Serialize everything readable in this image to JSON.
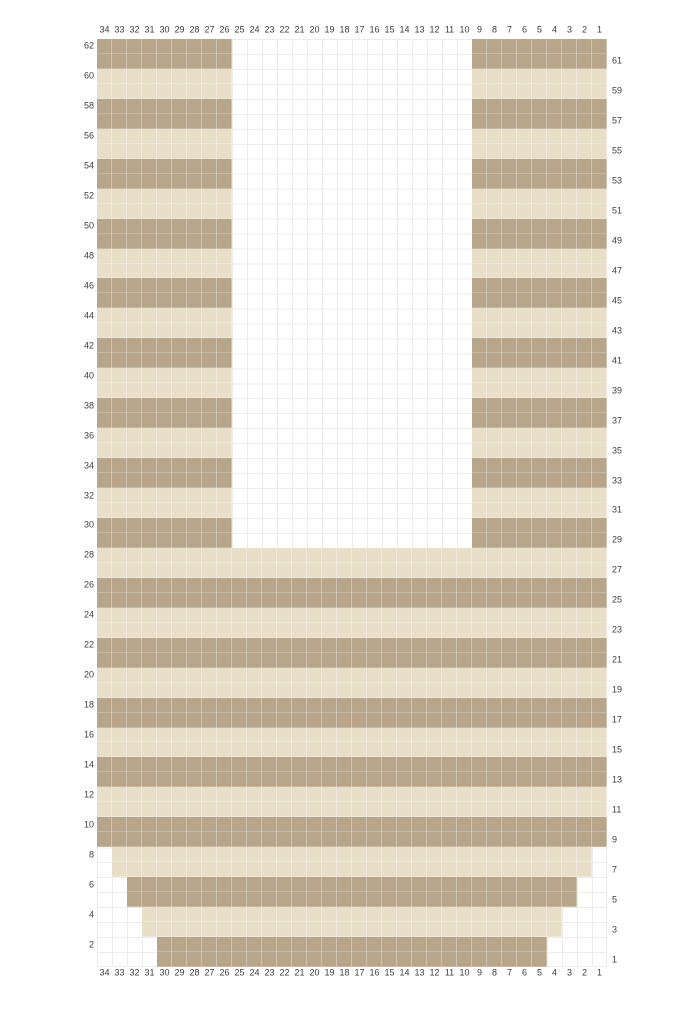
{
  "chart_data": {
    "type": "heatmap",
    "title": "",
    "description": "Two-color knitting/colorwork grid chart, 34 stitches wide by 62 rows tall, striped in two-row bands, with a center neck opening (columns 25-10 empty from row 29 upward) and stepped decrease shaping at the bottom corners (rows 1-8).",
    "columns_left_to_right": [
      34,
      33,
      32,
      31,
      30,
      29,
      28,
      27,
      26,
      25,
      24,
      23,
      22,
      21,
      20,
      19,
      18,
      17,
      16,
      15,
      14,
      13,
      12,
      11,
      10,
      9,
      8,
      7,
      6,
      5,
      4,
      3,
      2,
      1
    ],
    "rows_top_to_bottom": [
      62,
      61,
      60,
      59,
      58,
      57,
      56,
      55,
      54,
      53,
      52,
      51,
      50,
      49,
      48,
      47,
      46,
      45,
      44,
      43,
      42,
      41,
      40,
      39,
      38,
      37,
      36,
      35,
      34,
      33,
      32,
      31,
      30,
      29,
      28,
      27,
      26,
      25,
      24,
      23,
      22,
      21,
      20,
      19,
      18,
      17,
      16,
      15,
      14,
      13,
      12,
      11,
      10,
      9,
      8,
      7,
      6,
      5,
      4,
      3,
      2,
      1
    ],
    "colors": {
      "dark": "#b7a68b",
      "light": "#e9dfc9",
      "empty": "#ffffff",
      "gridline": "#ececec",
      "label": "#3d3d3d"
    },
    "stripe_rule": "two-row horizontal stripes; rows 1-2 dark, 3-4 light, alternating upward",
    "rows": [
      {
        "row": 62,
        "color": "dark",
        "spans": [
          [
            34,
            26
          ],
          [
            9,
            1
          ]
        ]
      },
      {
        "row": 61,
        "color": "dark",
        "spans": [
          [
            34,
            26
          ],
          [
            9,
            1
          ]
        ]
      },
      {
        "row": 60,
        "color": "light",
        "spans": [
          [
            34,
            26
          ],
          [
            9,
            1
          ]
        ]
      },
      {
        "row": 59,
        "color": "light",
        "spans": [
          [
            34,
            26
          ],
          [
            9,
            1
          ]
        ]
      },
      {
        "row": 58,
        "color": "dark",
        "spans": [
          [
            34,
            26
          ],
          [
            9,
            1
          ]
        ]
      },
      {
        "row": 57,
        "color": "dark",
        "spans": [
          [
            34,
            26
          ],
          [
            9,
            1
          ]
        ]
      },
      {
        "row": 56,
        "color": "light",
        "spans": [
          [
            34,
            26
          ],
          [
            9,
            1
          ]
        ]
      },
      {
        "row": 55,
        "color": "light",
        "spans": [
          [
            34,
            26
          ],
          [
            9,
            1
          ]
        ]
      },
      {
        "row": 54,
        "color": "dark",
        "spans": [
          [
            34,
            26
          ],
          [
            9,
            1
          ]
        ]
      },
      {
        "row": 53,
        "color": "dark",
        "spans": [
          [
            34,
            26
          ],
          [
            9,
            1
          ]
        ]
      },
      {
        "row": 52,
        "color": "light",
        "spans": [
          [
            34,
            26
          ],
          [
            9,
            1
          ]
        ]
      },
      {
        "row": 51,
        "color": "light",
        "spans": [
          [
            34,
            26
          ],
          [
            9,
            1
          ]
        ]
      },
      {
        "row": 50,
        "color": "dark",
        "spans": [
          [
            34,
            26
          ],
          [
            9,
            1
          ]
        ]
      },
      {
        "row": 49,
        "color": "dark",
        "spans": [
          [
            34,
            26
          ],
          [
            9,
            1
          ]
        ]
      },
      {
        "row": 48,
        "color": "light",
        "spans": [
          [
            34,
            26
          ],
          [
            9,
            1
          ]
        ]
      },
      {
        "row": 47,
        "color": "light",
        "spans": [
          [
            34,
            26
          ],
          [
            9,
            1
          ]
        ]
      },
      {
        "row": 46,
        "color": "dark",
        "spans": [
          [
            34,
            26
          ],
          [
            9,
            1
          ]
        ]
      },
      {
        "row": 45,
        "color": "dark",
        "spans": [
          [
            34,
            26
          ],
          [
            9,
            1
          ]
        ]
      },
      {
        "row": 44,
        "color": "light",
        "spans": [
          [
            34,
            26
          ],
          [
            9,
            1
          ]
        ]
      },
      {
        "row": 43,
        "color": "light",
        "spans": [
          [
            34,
            26
          ],
          [
            9,
            1
          ]
        ]
      },
      {
        "row": 42,
        "color": "dark",
        "spans": [
          [
            34,
            26
          ],
          [
            9,
            1
          ]
        ]
      },
      {
        "row": 41,
        "color": "dark",
        "spans": [
          [
            34,
            26
          ],
          [
            9,
            1
          ]
        ]
      },
      {
        "row": 40,
        "color": "light",
        "spans": [
          [
            34,
            26
          ],
          [
            9,
            1
          ]
        ]
      },
      {
        "row": 39,
        "color": "light",
        "spans": [
          [
            34,
            26
          ],
          [
            9,
            1
          ]
        ]
      },
      {
        "row": 38,
        "color": "dark",
        "spans": [
          [
            34,
            26
          ],
          [
            9,
            1
          ]
        ]
      },
      {
        "row": 37,
        "color": "dark",
        "spans": [
          [
            34,
            26
          ],
          [
            9,
            1
          ]
        ]
      },
      {
        "row": 36,
        "color": "light",
        "spans": [
          [
            34,
            26
          ],
          [
            9,
            1
          ]
        ]
      },
      {
        "row": 35,
        "color": "light",
        "spans": [
          [
            34,
            26
          ],
          [
            9,
            1
          ]
        ]
      },
      {
        "row": 34,
        "color": "dark",
        "spans": [
          [
            34,
            26
          ],
          [
            9,
            1
          ]
        ]
      },
      {
        "row": 33,
        "color": "dark",
        "spans": [
          [
            34,
            26
          ],
          [
            9,
            1
          ]
        ]
      },
      {
        "row": 32,
        "color": "light",
        "spans": [
          [
            34,
            26
          ],
          [
            9,
            1
          ]
        ]
      },
      {
        "row": 31,
        "color": "light",
        "spans": [
          [
            34,
            26
          ],
          [
            9,
            1
          ]
        ]
      },
      {
        "row": 30,
        "color": "dark",
        "spans": [
          [
            34,
            26
          ],
          [
            9,
            1
          ]
        ]
      },
      {
        "row": 29,
        "color": "dark",
        "spans": [
          [
            34,
            26
          ],
          [
            9,
            1
          ]
        ]
      },
      {
        "row": 28,
        "color": "light",
        "spans": [
          [
            34,
            1
          ]
        ]
      },
      {
        "row": 27,
        "color": "light",
        "spans": [
          [
            34,
            1
          ]
        ]
      },
      {
        "row": 26,
        "color": "dark",
        "spans": [
          [
            34,
            1
          ]
        ]
      },
      {
        "row": 25,
        "color": "dark",
        "spans": [
          [
            34,
            1
          ]
        ]
      },
      {
        "row": 24,
        "color": "light",
        "spans": [
          [
            34,
            1
          ]
        ]
      },
      {
        "row": 23,
        "color": "light",
        "spans": [
          [
            34,
            1
          ]
        ]
      },
      {
        "row": 22,
        "color": "dark",
        "spans": [
          [
            34,
            1
          ]
        ]
      },
      {
        "row": 21,
        "color": "dark",
        "spans": [
          [
            34,
            1
          ]
        ]
      },
      {
        "row": 20,
        "color": "light",
        "spans": [
          [
            34,
            1
          ]
        ]
      },
      {
        "row": 19,
        "color": "light",
        "spans": [
          [
            34,
            1
          ]
        ]
      },
      {
        "row": 18,
        "color": "dark",
        "spans": [
          [
            34,
            1
          ]
        ]
      },
      {
        "row": 17,
        "color": "dark",
        "spans": [
          [
            34,
            1
          ]
        ]
      },
      {
        "row": 16,
        "color": "light",
        "spans": [
          [
            34,
            1
          ]
        ]
      },
      {
        "row": 15,
        "color": "light",
        "spans": [
          [
            34,
            1
          ]
        ]
      },
      {
        "row": 14,
        "color": "dark",
        "spans": [
          [
            34,
            1
          ]
        ]
      },
      {
        "row": 13,
        "color": "dark",
        "spans": [
          [
            34,
            1
          ]
        ]
      },
      {
        "row": 12,
        "color": "light",
        "spans": [
          [
            34,
            1
          ]
        ]
      },
      {
        "row": 11,
        "color": "light",
        "spans": [
          [
            34,
            1
          ]
        ]
      },
      {
        "row": 10,
        "color": "dark",
        "spans": [
          [
            34,
            1
          ]
        ]
      },
      {
        "row": 9,
        "color": "dark",
        "spans": [
          [
            34,
            1
          ]
        ]
      },
      {
        "row": 8,
        "color": "light",
        "spans": [
          [
            33,
            2
          ]
        ]
      },
      {
        "row": 7,
        "color": "light",
        "spans": [
          [
            33,
            2
          ]
        ]
      },
      {
        "row": 6,
        "color": "dark",
        "spans": [
          [
            32,
            3
          ]
        ]
      },
      {
        "row": 5,
        "color": "dark",
        "spans": [
          [
            32,
            3
          ]
        ]
      },
      {
        "row": 4,
        "color": "light",
        "spans": [
          [
            31,
            4
          ]
        ]
      },
      {
        "row": 3,
        "color": "light",
        "spans": [
          [
            31,
            4
          ]
        ]
      },
      {
        "row": 2,
        "color": "dark",
        "spans": [
          [
            30,
            5
          ]
        ]
      },
      {
        "row": 1,
        "color": "dark",
        "spans": [
          [
            30,
            5
          ]
        ]
      }
    ]
  },
  "labels": {
    "top": [
      "34",
      "33",
      "32",
      "31",
      "30",
      "29",
      "28",
      "27",
      "26",
      "25",
      "24",
      "23",
      "22",
      "21",
      "20",
      "19",
      "18",
      "17",
      "16",
      "15",
      "14",
      "13",
      "12",
      "11",
      "10",
      "9",
      "8",
      "7",
      "6",
      "5",
      "4",
      "3",
      "2",
      "1"
    ],
    "bottom": [
      "34",
      "33",
      "32",
      "31",
      "30",
      "29",
      "28",
      "27",
      "26",
      "25",
      "24",
      "23",
      "22",
      "21",
      "20",
      "19",
      "18",
      "17",
      "16",
      "15",
      "14",
      "13",
      "12",
      "11",
      "10",
      "9",
      "8",
      "7",
      "6",
      "5",
      "4",
      "3",
      "2",
      "1"
    ],
    "left": [
      "62",
      "60",
      "58",
      "56",
      "54",
      "52",
      "50",
      "48",
      "46",
      "44",
      "42",
      "40",
      "38",
      "36",
      "34",
      "32",
      "30",
      "28",
      "26",
      "24",
      "22",
      "20",
      "18",
      "16",
      "14",
      "12",
      "10",
      "8",
      "6",
      "4",
      "2"
    ],
    "right": [
      "61",
      "59",
      "57",
      "55",
      "53",
      "51",
      "49",
      "47",
      "45",
      "43",
      "41",
      "39",
      "37",
      "35",
      "33",
      "31",
      "29",
      "27",
      "25",
      "23",
      "21",
      "19",
      "17",
      "15",
      "13",
      "11",
      "9",
      "7",
      "5",
      "3",
      "1"
    ]
  }
}
